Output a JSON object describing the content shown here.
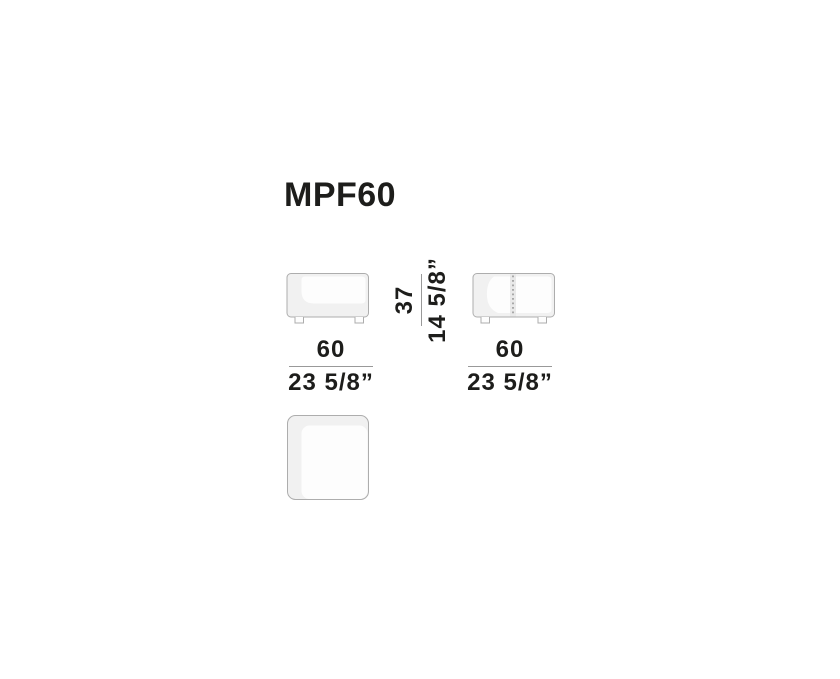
{
  "colors": {
    "background": "#ffffff",
    "text": "#1d1d1b",
    "outline": "#adadad",
    "fill_shade": "#f1f1f1",
    "fill_highlight": "#fdfdfd",
    "seam_band": "#e9e9e9",
    "seam_dots": "#9c9c9c",
    "dimension_line": "#999999"
  },
  "product": {
    "code": "MPF60"
  },
  "dimensions": {
    "front_width": {
      "metric": "60",
      "imperial": "23 5/8”"
    },
    "side_width": {
      "metric": "60",
      "imperial": "23 5/8”"
    },
    "height": {
      "metric": "37",
      "imperial": "14 5/8”"
    }
  }
}
